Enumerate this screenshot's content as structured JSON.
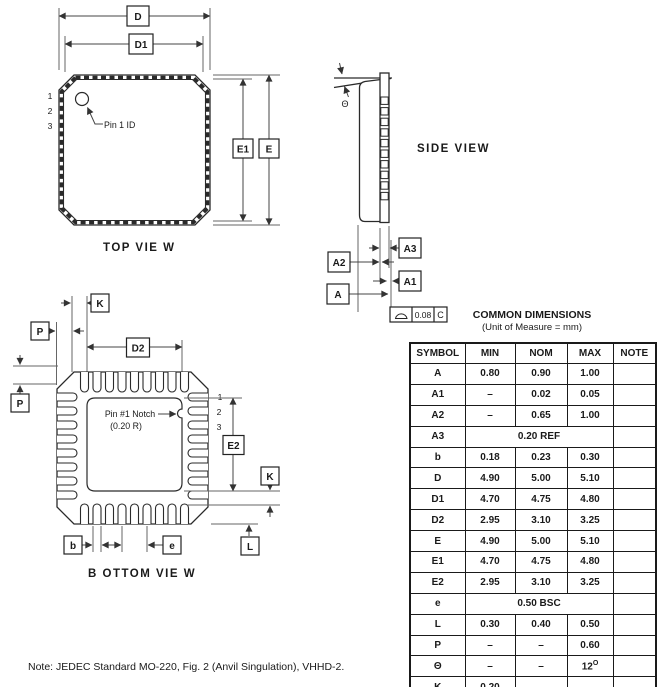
{
  "top_view": {
    "caption": "TOP VIE W",
    "pin1_label": "Pin 1 ID",
    "pin_numbers": [
      "1",
      "2",
      "3"
    ],
    "dims": {
      "D": "D",
      "D1": "D1",
      "E": "E",
      "E1": "E1"
    }
  },
  "side_view": {
    "caption": "SIDE VIEW",
    "theta": "Θ",
    "dims": {
      "A": "A",
      "A1": "A1",
      "A2": "A2",
      "A3": "A3"
    },
    "flatness": {
      "tolerance": "0.08",
      "datum": "C"
    }
  },
  "bottom_view": {
    "caption": "B OTTOM VIE W",
    "notch_label_line1": "Pin #1 Notch",
    "notch_label_line2": "(0.20 R)",
    "pin_numbers": [
      "1",
      "2",
      "3"
    ],
    "dims": {
      "K": "K",
      "P": "P",
      "P2": "P",
      "D2": "D2",
      "E2": "E2",
      "K2": "K",
      "L": "L",
      "b": "b",
      "e": "e"
    }
  },
  "table": {
    "title": "COMMON DIMENSIONS",
    "subtitle": "(Unit of Measure = mm)",
    "headers": [
      "SYMBOL",
      "MIN",
      "NOM",
      "MAX",
      "NOTE"
    ],
    "rows": [
      {
        "symbol": "A",
        "min": "0.80",
        "nom": "0.90",
        "max": "1.00",
        "note": ""
      },
      {
        "symbol": "A1",
        "min": "–",
        "nom": "0.02",
        "max": "0.05",
        "note": ""
      },
      {
        "symbol": "A2",
        "min": "–",
        "nom": "0.65",
        "max": "1.00",
        "note": ""
      },
      {
        "symbol": "A3",
        "span": "0.20 REF",
        "note": ""
      },
      {
        "symbol": "b",
        "min": "0.18",
        "nom": "0.23",
        "max": "0.30",
        "note": ""
      },
      {
        "symbol": "D",
        "min": "4.90",
        "nom": "5.00",
        "max": "5.10",
        "note": ""
      },
      {
        "symbol": "D1",
        "min": "4.70",
        "nom": "4.75",
        "max": "4.80",
        "note": ""
      },
      {
        "symbol": "D2",
        "min": "2.95",
        "nom": "3.10",
        "max": "3.25",
        "note": ""
      },
      {
        "symbol": "E",
        "min": "4.90",
        "nom": "5.00",
        "max": "5.10",
        "note": ""
      },
      {
        "symbol": "E1",
        "min": "4.70",
        "nom": "4.75",
        "max": "4.80",
        "note": ""
      },
      {
        "symbol": "E2",
        "min": "2.95",
        "nom": "3.10",
        "max": "3.25",
        "note": ""
      },
      {
        "symbol": "e",
        "span": "0.50 BSC",
        "note": ""
      },
      {
        "symbol": "L",
        "min": "0.30",
        "nom": "0.40",
        "max": "0.50",
        "note": ""
      },
      {
        "symbol": "P",
        "min": "–",
        "nom": "–",
        "max": "0.60",
        "note": ""
      },
      {
        "symbol": "Θ",
        "min": "–",
        "nom": "–",
        "max": "12",
        "max_sup": "O",
        "note": ""
      },
      {
        "symbol": "K",
        "min": "0.20",
        "nom": "–",
        "max": "–",
        "note": ""
      }
    ]
  },
  "note": "Note:  JEDEC Standard MO-220, Fig. 2 (Anvil Singulation), VHHD-2."
}
